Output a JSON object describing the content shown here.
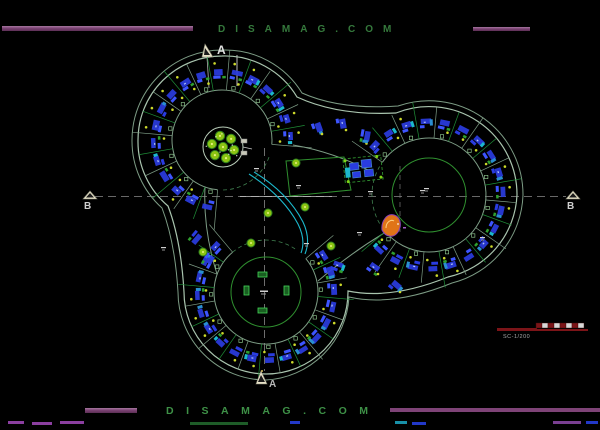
{
  "watermark": {
    "top": "DISAMAG.COM",
    "bottom": "DISAMAG.COM"
  },
  "section_markers": {
    "a_top": "A",
    "a_bottom": "A",
    "b_left": "B",
    "b_right": "B"
  },
  "scale_bar": {
    "label": "SC-1/200"
  },
  "colors": {
    "background": "#000000",
    "watermark_green_top": "#35793c",
    "watermark_green_bottom": "#3e9147",
    "bar_purple": "#7c4374",
    "bar_purple_light": "#a678a0",
    "band_edge": "#7d9c85",
    "band_edge_bright": "#a9c4ae",
    "radial_green": "#1f8f38",
    "inner_green": "#2f8f2f",
    "block_blue": "#2a3ce0",
    "block_blue_bright": "#3d55ff",
    "cyan": "#1cb8cc",
    "dot_yellow": "#ccd92b",
    "tree_fill": "#8cc513",
    "tree_stroke": "#2f7f1f",
    "white": "#d9d9d9",
    "scale_red": "#7c1418",
    "orange": "#e07418",
    "purple_accent": "#8840b8",
    "centerline_gray": "#8a8a8a"
  },
  "plan": {
    "lobes": [
      {
        "name": "top-left lobe",
        "cx": 222,
        "cy": 140,
        "r_in": 50,
        "r_out": 84,
        "court_r": 0,
        "angle_start": 95,
        "angle_end": 365,
        "step": 15,
        "open_a": 20,
        "open_b": 90
      },
      {
        "name": "right lobe",
        "cx": 429,
        "cy": 195,
        "r_in": 57,
        "r_out": 88,
        "court_r": 37,
        "angle_start": -145,
        "angle_end": 140,
        "step": 15,
        "open_a": 150,
        "open_b": 210
      },
      {
        "name": "bottom lobe",
        "cx": 266,
        "cy": 292,
        "r_in": 52,
        "r_out": 82,
        "court_r": 35,
        "angle_start": -40,
        "angle_end": 230,
        "step": 15,
        "open_a": 230,
        "open_b": 305
      }
    ],
    "outline_outer": "M 222,56 A 84 84 0 0 1 297,97 Q 338,116 396,113 A 88 88 0 0 1 517,195 A 88 88 0 0 1 448,277 Q 391,300 348,291 A 82 82 0 0 1 266,374 A 82 82 0 0 1 184,292 Q 181,240 168,206 A 84 84 0 0 1 138,140 A 84 84 0 0 1 222,56 Z",
    "outline_outer2": "M 222,50 A 90 90 0 0 1 302,93 Q 340,110 398,106 A 94 94 0 0 1 523,195 A 94 94 0 0 1 452,283 Q 393,307 349,297 A 88 88 0 0 1 266,380 A 88 88 0 0 1 178,292 Q 175,242 162,208 A 90 90 0 0 1 132,140 A 90 90 0 0 1 222,50 Z",
    "corridor_walls": [
      "M 293,145 Q 334,152 372,172",
      "M 386,232 Q 352,252 318,281",
      "M 217,274 Q 203,230 205,187"
    ],
    "cyan_paths": [
      "M 249,174 Q 283,196 298,224 Q 306,240 301,253",
      "M 254,172 Q 288,193 303,222 Q 311,239 305,254"
    ],
    "court_quad": "M 286,161 L 344,157 L 351,190 L 290,196 Z",
    "pool": {
      "x": 344,
      "y": 157,
      "w": 38,
      "h": 24,
      "rot": -6,
      "blocks": [
        [
          350,
          162,
          9,
          7
        ],
        [
          362,
          160,
          10,
          8
        ],
        [
          352,
          171,
          8,
          6
        ],
        [
          364,
          170,
          9,
          7
        ]
      ],
      "cyan_block": [
        345,
        166,
        5,
        10
      ],
      "corner_dots": [
        [
          346,
          159
        ],
        [
          378,
          158
        ],
        [
          347,
          180
        ],
        [
          380,
          179
        ]
      ]
    },
    "plaza": {
      "cx": 223,
      "cy": 147,
      "r": 20,
      "ring_r": 11.5,
      "tree_r": 4.6,
      "tabs": [
        [
          241,
          139,
          6,
          4
        ],
        [
          241,
          151,
          6,
          4
        ]
      ]
    },
    "b_court_rects": [
      [
        258,
        272,
        9,
        5
      ],
      [
        258,
        308,
        9,
        5
      ],
      [
        244,
        286,
        5,
        9
      ],
      [
        284,
        286,
        5,
        9
      ]
    ],
    "trees": [
      [
        296,
        163
      ],
      [
        305,
        207
      ],
      [
        268,
        213
      ],
      [
        331,
        246
      ],
      [
        251,
        243
      ],
      [
        203,
        252
      ]
    ],
    "tiny_labels": [
      [
        296,
        185
      ],
      [
        304,
        243
      ],
      [
        357,
        232
      ],
      [
        385,
        230
      ],
      [
        480,
        237
      ],
      [
        424,
        188
      ],
      [
        368,
        191
      ],
      [
        254,
        168
      ],
      [
        161,
        247
      ],
      [
        420,
        190
      ]
    ],
    "corridor_clusters": [
      [
        318,
        128,
        70
      ],
      [
        342,
        124,
        80
      ],
      [
        366,
        136,
        100
      ],
      [
        374,
        268,
        35
      ],
      [
        396,
        286,
        40
      ],
      [
        196,
        238,
        130
      ],
      [
        209,
        260,
        120
      ],
      [
        338,
        266,
        20
      ]
    ],
    "orange_blob": "M 382,230 C 381,221 387,213 394,215 C 401,217 402,226 398,232 C 394,238 386,238 382,230 Z",
    "header_bars": {
      "left": [
        2,
        26,
        191,
        5
      ],
      "right": [
        473,
        27,
        57,
        4
      ]
    },
    "footer_bars": {
      "left": [
        85,
        408,
        52,
        5
      ],
      "right": [
        390,
        408,
        210,
        4
      ]
    },
    "footer_fragments": [
      [
        8,
        421,
        16,
        "#8b3fa0"
      ],
      [
        32,
        422,
        20,
        "#8b3fa0"
      ],
      [
        60,
        421,
        24,
        "#8b3fa0"
      ],
      [
        190,
        422,
        58,
        "#1e5c28"
      ],
      [
        290,
        421,
        10,
        "#2238c8"
      ],
      [
        395,
        421,
        12,
        "#1890a8"
      ],
      [
        412,
        422,
        14,
        "#2238c8"
      ],
      [
        553,
        421,
        28,
        "#7a3f92"
      ],
      [
        586,
        421,
        12,
        "#2238c8"
      ]
    ],
    "scale_geom": {
      "line": [
        497,
        330,
        588,
        330
      ],
      "bar": [
        497,
        328,
        40,
        3
      ],
      "seg_x": 536,
      "seg_y": 323,
      "seg_w": 6,
      "seg_h": 5,
      "seg_n": 8
    }
  }
}
